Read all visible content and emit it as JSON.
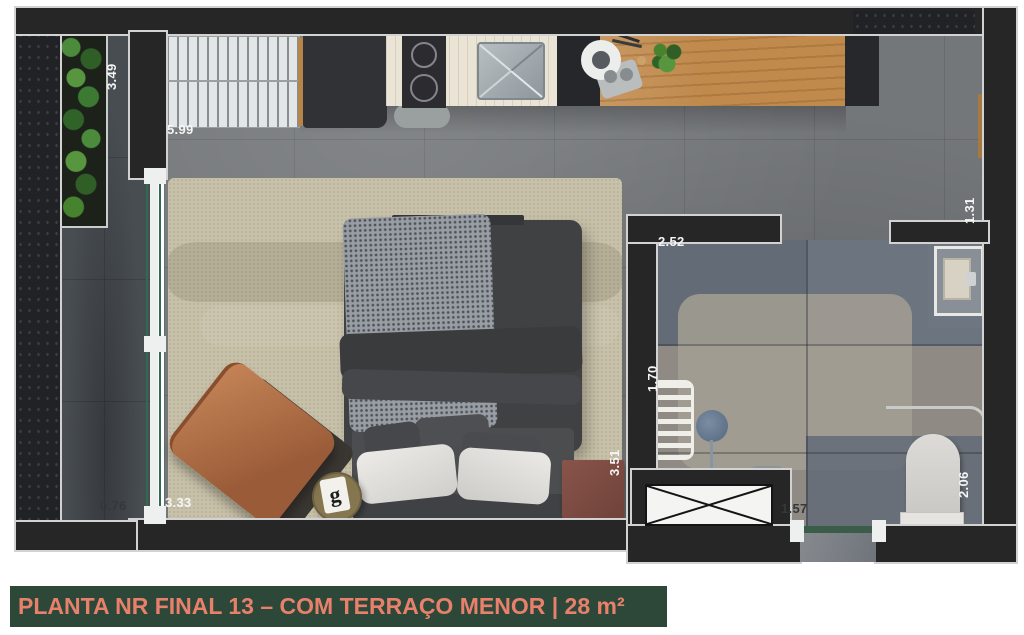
{
  "title": {
    "text": "PLANTA NR FINAL 13 – COM TERRAÇO MENOR | 28 m²"
  },
  "dimensions": {
    "terrace_length": "3.49",
    "kitchen_wall_length": "5.99",
    "right_wall_segment": "1.31",
    "bathroom_width": "2.52",
    "bathroom_inner_length": "1.70",
    "bedroom_length": "3.51",
    "terrace_width": "0.76",
    "bedroom_bottom_wall": "3.33",
    "entry_hall_width": "1.57",
    "bathroom_right_length": "2.06"
  },
  "decor": {
    "side_table_monogram": "g"
  },
  "colors": {
    "wall": "#262626",
    "wall_outline": "#d2d2d2",
    "floor_main": "#74777a",
    "floor_terrace": "#484d52",
    "floor_bathroom": "#8f8b84",
    "rug": "#c9c2aa",
    "bed_duvet": "#3f4143",
    "bed_throw": "#989ca3",
    "kitchen_wood": "#c08a4d",
    "kitchen_counter": "#eae4d7",
    "chair_leather": "#b0714f",
    "plant_green": "#3c7a33",
    "glass_green": "#2f6b51",
    "title_bg": "#2d4839",
    "title_text": "#e8806b"
  }
}
